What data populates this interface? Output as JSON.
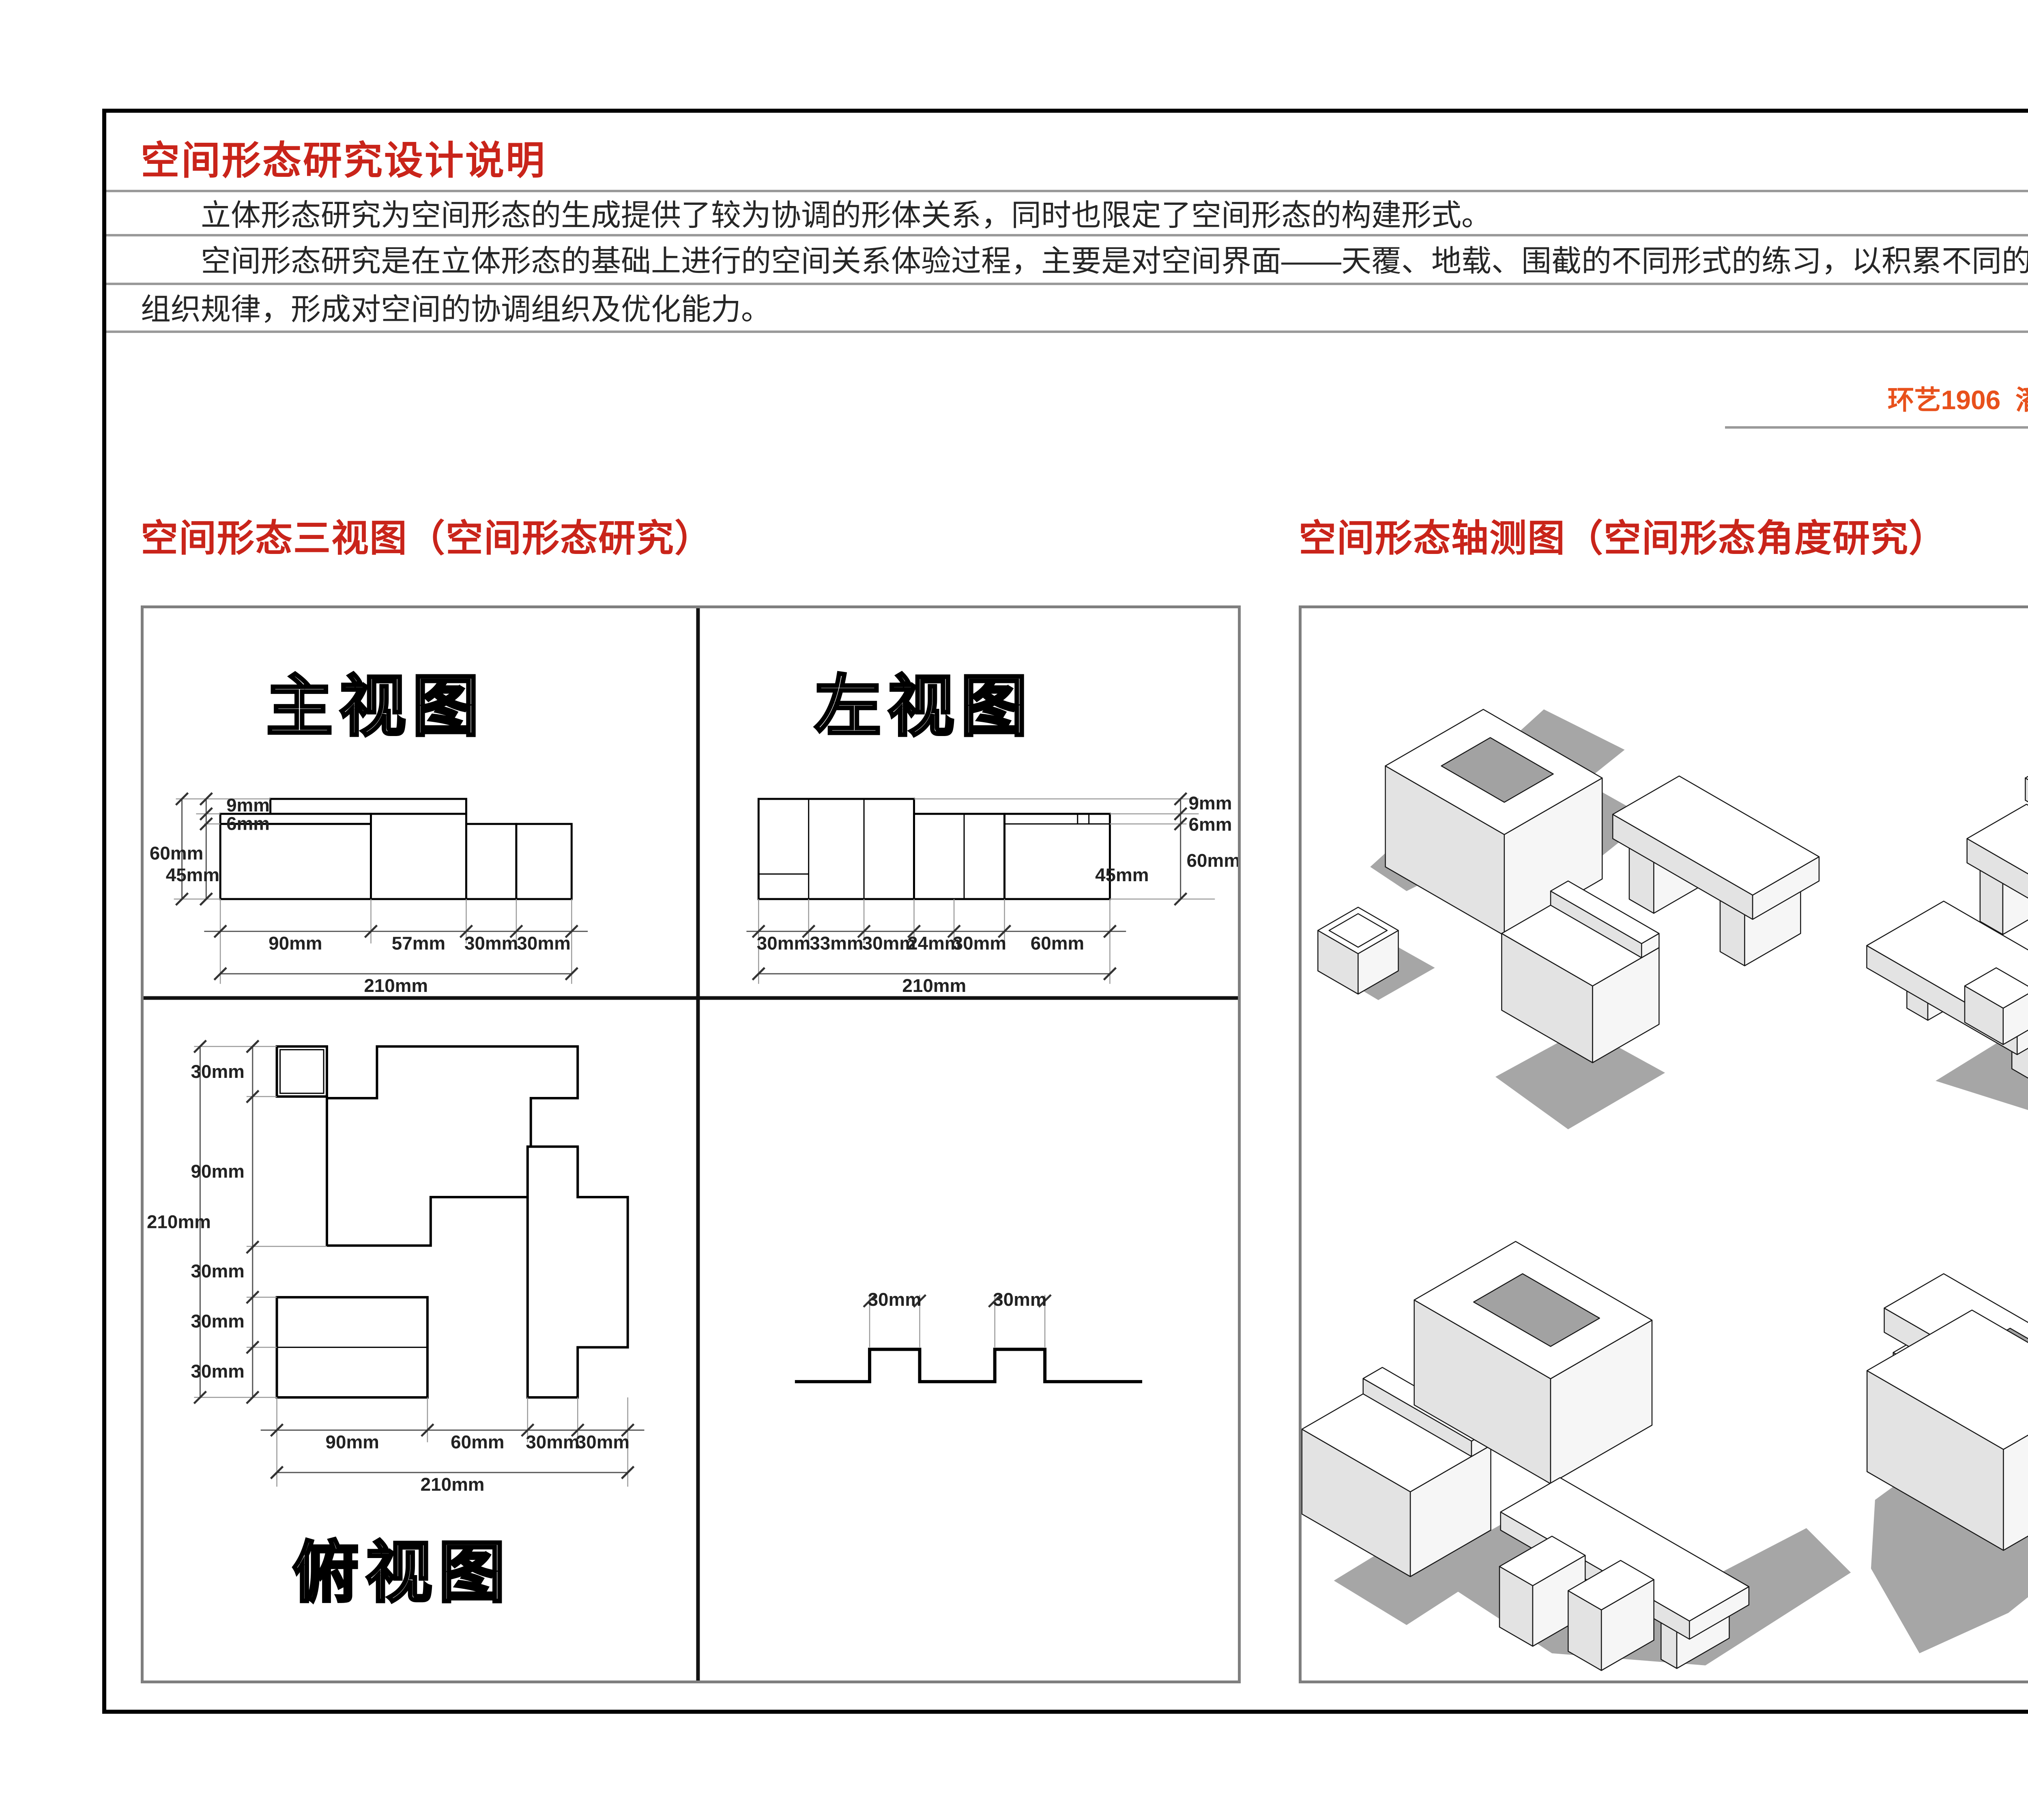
{
  "header": {
    "title": "空间形态研究设计说明",
    "p1": "立体形态研究为空间形态的生成提供了较为协调的形体关系，同时也限定了空间形态的构建形式。",
    "p2a": "空间形态研究是在立体形态的基础上进行的空间关系体验过程，主要是对空间界面——天覆、地载、围截的不同形式的练习，以积累不同的空间构建形式及其",
    "p2b": "组织规律，形成对空间的协调组织及优化能力。",
    "signature": "环艺1906  潘雅轩   201940283"
  },
  "three_view": {
    "heading": "空间形态三视图（空间形态研究）",
    "front": {
      "label": "主视图",
      "side": [
        "9mm",
        "6mm",
        "60mm",
        "45mm"
      ],
      "bottom": [
        "90mm",
        "57mm",
        "30mm",
        "30mm"
      ],
      "total": "210mm"
    },
    "left": {
      "label": "左视图",
      "side": [
        "9mm",
        "6mm",
        "60mm",
        "45mm"
      ],
      "bottom": [
        "30mm",
        "33mm",
        "30mm",
        "24mm",
        "30mm",
        "60mm"
      ],
      "total": "210mm"
    },
    "top": {
      "label": "俯视图",
      "side": [
        "30mm",
        "90mm",
        "30mm",
        "30mm",
        "30mm"
      ],
      "side_total": "210mm",
      "bottom": [
        "90mm",
        "60mm",
        "30mm",
        "30mm"
      ],
      "total": "210mm"
    },
    "profile": {
      "dims": [
        "30mm",
        "30mm"
      ]
    }
  },
  "axon": {
    "heading": "空间形态轴测图（空间形态角度研究）"
  },
  "colors": {
    "title_red": "#c9241a",
    "signature_orange": "#e8511c",
    "rule_gray": "#9a9a9a",
    "panel_border_gray": "#7f7f7f",
    "shadow_gray": "#a6a6a6"
  }
}
